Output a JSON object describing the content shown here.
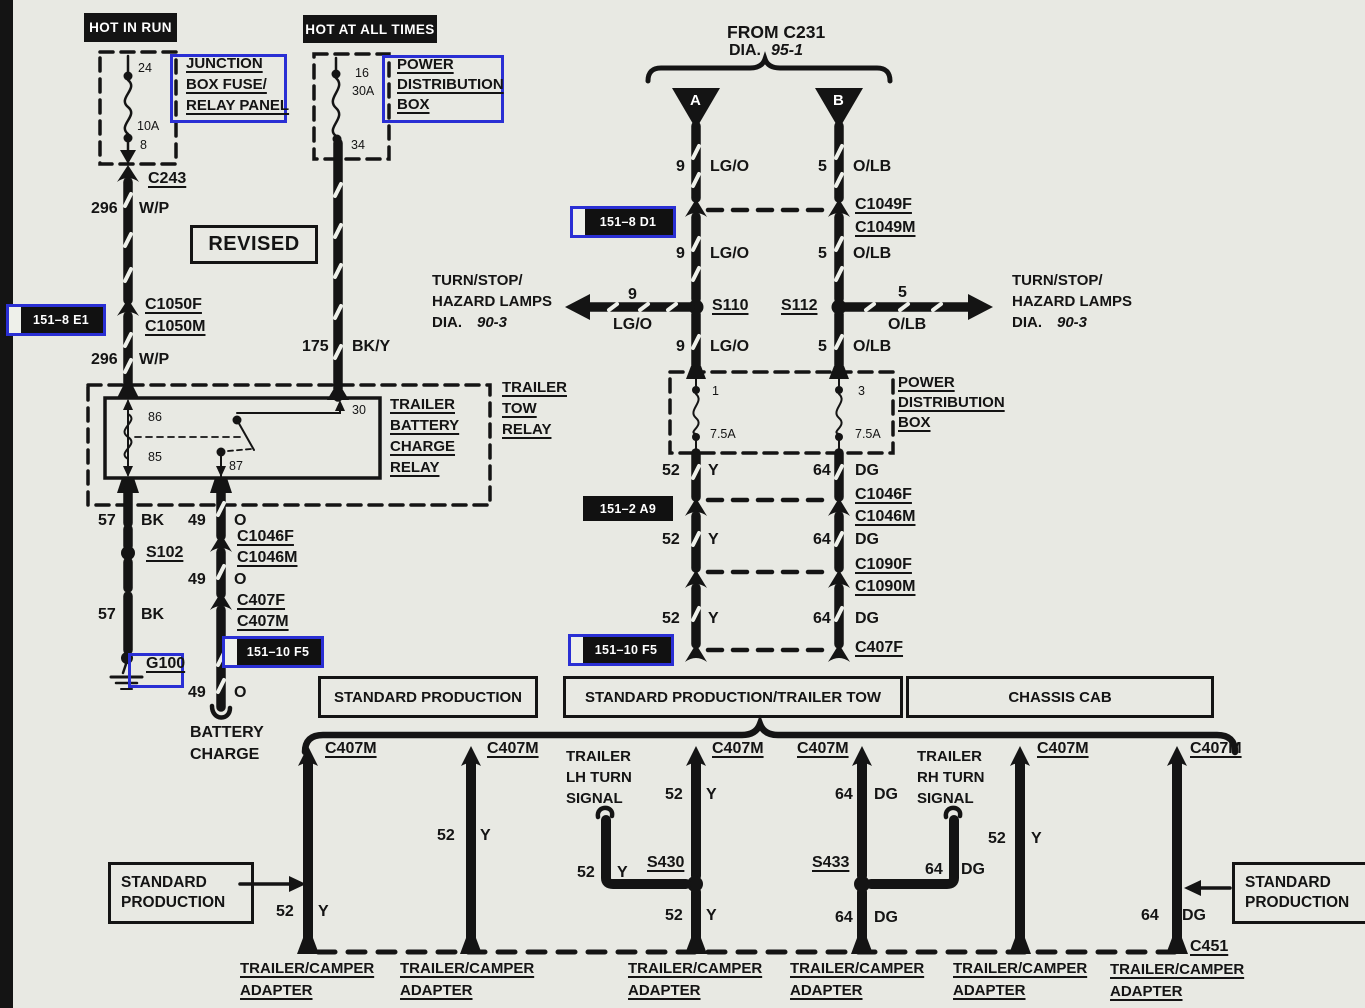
{
  "colors": {
    "background": "#e8e9e3",
    "ink": "#141414",
    "annotation_blue": "#2a2fd4",
    "badge_bg": "#111111",
    "badge_fg": "#ffffff"
  },
  "hot_in_run": {
    "header": "HOT IN RUN",
    "pin_top": "24",
    "fuse_rating": "10A",
    "pin_bottom": "8",
    "panel_line1": "JUNCTION",
    "panel_line2": "BOX FUSE/",
    "panel_line3": "RELAY PANEL",
    "connector": "C243",
    "circuit": "296",
    "wire_color": "W/P",
    "grid_ref": "151–8 E1",
    "connector_f": "C1050F",
    "connector_m": "C1050M"
  },
  "hot_at_all_times": {
    "header": "HOT AT ALL TIMES",
    "pin_top": "16",
    "fuse_rating": "30A",
    "pin_bottom": "34",
    "box_line1": "POWER",
    "box_line2": "DISTRIBUTION",
    "box_line3": "BOX",
    "circuit": "175",
    "wire_color": "BK/Y"
  },
  "revised_stamp": "REVISED",
  "from_c231": {
    "title": "FROM C231",
    "dia_label": "DIA.",
    "dia_value": "95-1",
    "terminal_a": "A",
    "terminal_b": "B",
    "grid_ref": "151–8 D1",
    "connector_f": "C1049F",
    "connector_m": "C1049M",
    "circuit_a": "9",
    "color_a": "LG/O",
    "circuit_b": "5",
    "color_b": "O/LB",
    "splice_left": "S110",
    "splice_right": "S112"
  },
  "turn_stop_left": {
    "line1": "TURN/STOP/",
    "line2": "HAZARD LAMPS",
    "dia_label": "DIA.",
    "dia_value": "90-3"
  },
  "turn_stop_right": {
    "line1": "TURN/STOP/",
    "line2": "HAZARD LAMPS",
    "dia_label": "DIA.",
    "dia_value": "90-3"
  },
  "power_dist_box_right": {
    "line1": "POWER",
    "line2": "DISTRIBUTION",
    "line3": "BOX",
    "pin_left": "1",
    "pin_right": "3",
    "fuse_left": "7.5A",
    "fuse_right": "7.5A"
  },
  "trailer_tow_relay": {
    "outer_line1": "TRAILER",
    "outer_line2": "TOW",
    "outer_line3": "RELAY",
    "inner_line1": "TRAILER",
    "inner_line2": "BATTERY",
    "inner_line3": "CHARGE",
    "inner_line4": "RELAY",
    "pin_86": "86",
    "pin_85": "85",
    "pin_30": "30",
    "pin_87": "87"
  },
  "left_branch": {
    "circuit_bk": "57",
    "color_bk": "BK",
    "splice": "S102",
    "ground": "G100",
    "circuit_o": "49",
    "color_o": "O",
    "connector_f1": "C1046F",
    "connector_m1": "C1046M",
    "connector_f2": "C407F",
    "connector_m2": "C407M",
    "grid_ref": "151–10 F5",
    "dest_line1": "BATTERY",
    "dest_line2": "CHARGE"
  },
  "right_branch": {
    "circuit_y": "52",
    "color_y": "Y",
    "circuit_dg": "64",
    "color_dg": "DG",
    "grid_ref_a9": "151–2 A9",
    "grid_ref_f5": "151–10 F5",
    "connector_f1": "C1046F",
    "connector_m1": "C1046M",
    "connector_f2": "C1090F",
    "connector_m2": "C1090M",
    "connector_f3": "C407F"
  },
  "variant_headers": {
    "standard_production": "STANDARD PRODUCTION",
    "standard_production_trailer_tow": "STANDARD PRODUCTION/TRAILER TOW",
    "chassis_cab": "CHASSIS CAB"
  },
  "bottom": {
    "connector_m": "C407M",
    "circuit_y": "52",
    "color_y": "Y",
    "circuit_dg": "64",
    "color_dg": "DG",
    "splice_lh": "S430",
    "splice_rh": "S433",
    "lh_line1": "TRAILER",
    "lh_line2": "LH TURN",
    "lh_line3": "SIGNAL",
    "rh_line1": "TRAILER",
    "rh_line2": "RH TURN",
    "rh_line3": "SIGNAL",
    "std_prod_line1": "STANDARD",
    "std_prod_line2": "PRODUCTION",
    "connector_c451": "C451",
    "adapter_line1": "TRAILER/CAMPER",
    "adapter_line2": "ADAPTER"
  }
}
